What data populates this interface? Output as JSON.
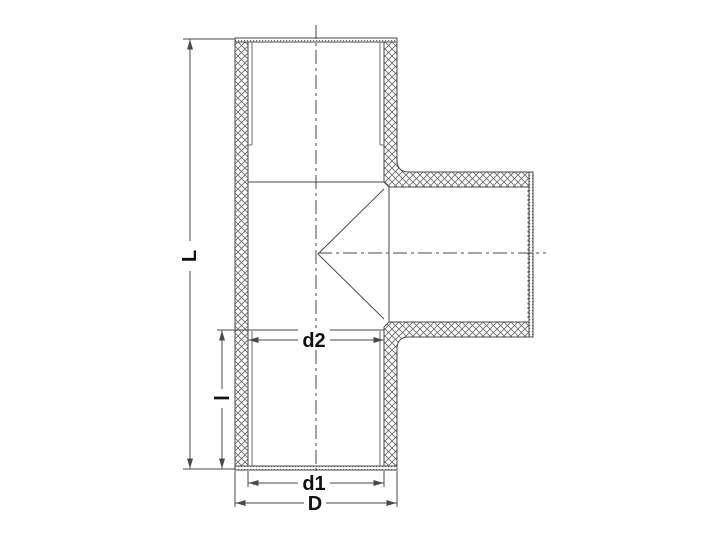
{
  "diagram": {
    "dimension_labels": {
      "L": "L",
      "l": "l",
      "d2": "d2",
      "d1": "d1",
      "D": "D"
    },
    "colors": {
      "background": "#ffffff",
      "line": "#4a4a4a",
      "hatch": "#6d6d6d",
      "label": "#111111"
    }
  }
}
